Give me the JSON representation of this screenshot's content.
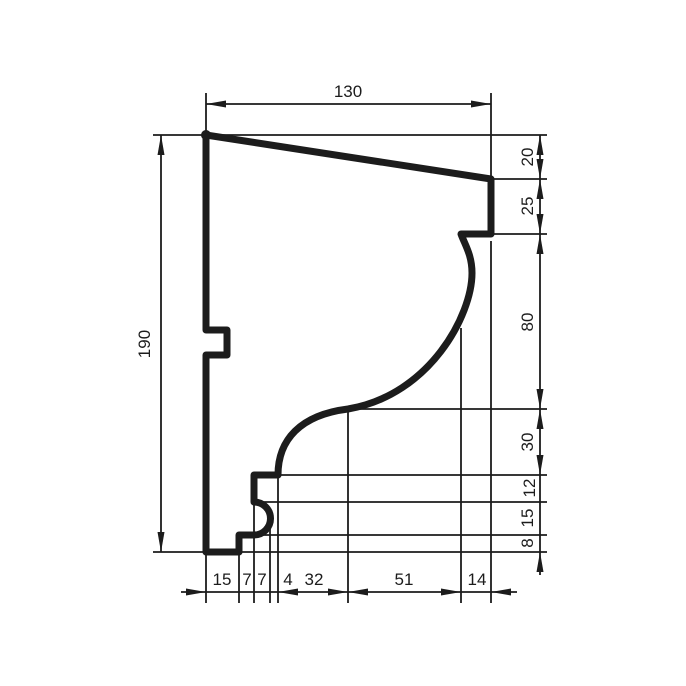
{
  "colors": {
    "line": "#1c1c1c",
    "background": "#ffffff"
  },
  "dimensions": {
    "top": "130",
    "left": "190",
    "right": [
      "20",
      "25",
      "80",
      "30",
      "12",
      "15",
      "8"
    ],
    "bottom": [
      "15",
      "7",
      "7",
      "4",
      "32",
      "51",
      "14"
    ]
  }
}
